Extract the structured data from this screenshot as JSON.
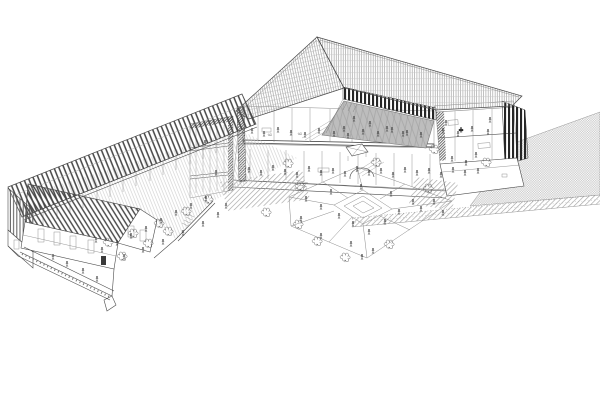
{
  "colors": {
    "background": "#ffffff",
    "line": "#4b4b4b",
    "line_light": "#9a9a9a",
    "roof_stripe": "#454545",
    "roof_hatch": "#8f8f8f",
    "roof_hatch_cross": "#c4c4c4",
    "louver_dark": "#262626",
    "louver_mid": "#5a5a5a",
    "poche_hatch": "#4a4a4a",
    "ground_hatch": "#9d9d9d",
    "ground_checker": "#c8c8c8",
    "courtyard_floor": "#bdbdbd",
    "courtyard_grid": "#9a9a9a",
    "paving_light": "#c4c4c4",
    "figure": "#3f3f3f",
    "tree": "#5f5f5f"
  },
  "scene": {
    "parts": [
      "left-wing-building",
      "left-wing-roof",
      "left-gable-louvers",
      "left-courtyard",
      "front-wing-roof",
      "front-facade",
      "entry-ramp",
      "main-building",
      "main-roof-left-plane",
      "main-roof-right-plane",
      "clerestory-louvers",
      "central-courtyard",
      "section-cut-interior",
      "stair-tower",
      "right-rooms",
      "right-louver-wall",
      "right-plinth",
      "public-plaza",
      "plaza-diamond-paving",
      "plaza-pavilion",
      "hatched-ground-strip-left",
      "hatched-ground-strip-right",
      "ground-checker-field",
      "roadway-band"
    ]
  },
  "figures": {
    "people": [
      [
        252,
        128
      ],
      [
        264,
        131
      ],
      [
        278,
        127
      ],
      [
        291,
        130
      ],
      [
        305,
        132
      ],
      [
        319,
        128
      ],
      [
        334,
        131
      ],
      [
        348,
        133
      ],
      [
        363,
        129
      ],
      [
        378,
        131
      ],
      [
        392,
        127
      ],
      [
        407,
        130
      ],
      [
        421,
        132
      ],
      [
        443,
        128
      ],
      [
        458,
        131
      ],
      [
        472,
        126
      ],
      [
        488,
        129
      ],
      [
        249,
        167
      ],
      [
        261,
        170
      ],
      [
        273,
        165
      ],
      [
        285,
        169
      ],
      [
        297,
        172
      ],
      [
        309,
        166
      ],
      [
        321,
        170
      ],
      [
        333,
        168
      ],
      [
        345,
        171
      ],
      [
        357,
        166
      ],
      [
        369,
        170
      ],
      [
        381,
        168
      ],
      [
        393,
        172
      ],
      [
        405,
        167
      ],
      [
        417,
        170
      ],
      [
        429,
        168
      ],
      [
        441,
        172
      ],
      [
        453,
        167
      ],
      [
        465,
        170
      ],
      [
        478,
        168
      ],
      [
        354,
        116
      ],
      [
        370,
        121
      ],
      [
        387,
        126
      ],
      [
        403,
        131
      ],
      [
        344,
        126
      ],
      [
        102,
        247
      ],
      [
        117,
        240
      ],
      [
        131,
        233
      ],
      [
        146,
        226
      ],
      [
        161,
        218
      ],
      [
        176,
        210
      ],
      [
        191,
        203
      ],
      [
        206,
        196
      ],
      [
        124,
        254
      ],
      [
        143,
        247
      ],
      [
        163,
        239
      ],
      [
        183,
        230
      ],
      [
        203,
        221
      ],
      [
        218,
        212
      ],
      [
        96,
        237
      ],
      [
        226,
        203
      ],
      [
        306,
        196
      ],
      [
        321,
        204
      ],
      [
        339,
        213
      ],
      [
        353,
        221
      ],
      [
        369,
        229
      ],
      [
        385,
        219
      ],
      [
        399,
        209
      ],
      [
        413,
        199
      ],
      [
        331,
        189
      ],
      [
        361,
        184
      ],
      [
        391,
        191
      ],
      [
        421,
        206
      ],
      [
        351,
        241
      ],
      [
        373,
        248
      ],
      [
        321,
        233
      ],
      [
        301,
        216
      ],
      [
        434,
        199
      ],
      [
        443,
        210
      ],
      [
        362,
        254
      ],
      [
        53,
        254
      ],
      [
        67,
        261
      ],
      [
        83,
        268
      ],
      [
        97,
        276
      ],
      [
        446,
        120
      ],
      [
        461,
        127
      ],
      [
        476,
        152
      ],
      [
        490,
        117
      ],
      [
        452,
        156
      ],
      [
        466,
        160
      ],
      [
        205,
        140
      ],
      [
        216,
        170
      ]
    ],
    "trees": [
      [
        108,
        243
      ],
      [
        133,
        234
      ],
      [
        159,
        224
      ],
      [
        186,
        212
      ],
      [
        208,
        200
      ],
      [
        122,
        257
      ],
      [
        168,
        232
      ],
      [
        148,
        244
      ],
      [
        298,
        225
      ],
      [
        317,
        242
      ],
      [
        389,
        245
      ],
      [
        428,
        189
      ],
      [
        300,
        187
      ],
      [
        266,
        213
      ],
      [
        345,
        258
      ],
      [
        288,
        164
      ],
      [
        376,
        163
      ],
      [
        486,
        163
      ],
      [
        434,
        150
      ]
    ]
  }
}
